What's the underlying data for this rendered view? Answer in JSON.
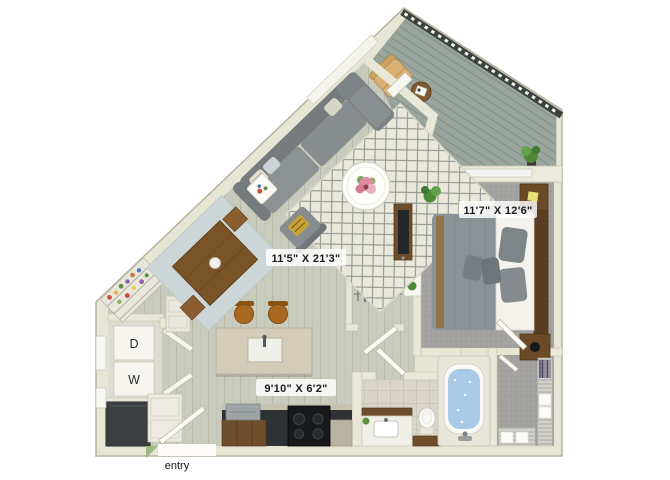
{
  "floorplan": {
    "type": "apartment-floor-plan-3d-top-view",
    "labels": {
      "living_dim": "11'5\" X 21'3\"",
      "bedroom_dim": "11'7\" X 12'6\"",
      "kitchen_dim": "9'10\" X 6'2\"",
      "entry": "entry",
      "dryer": "D",
      "washer": "W"
    },
    "rooms": [
      {
        "name": "living-dining",
        "dimensions": "11'5\" X 21'3\"",
        "floor": "light wood plank"
      },
      {
        "name": "bedroom",
        "dimensions": "11'7\" X 12'6\"",
        "floor": "gray carpet"
      },
      {
        "name": "kitchen",
        "dimensions": "9'10\" X 6'2\"",
        "floor": "light wood plank"
      },
      {
        "name": "bathroom",
        "floor": "beige tile"
      },
      {
        "name": "walk-in-closet",
        "floor": "gray carpet"
      },
      {
        "name": "balcony",
        "floor": "diagonal gray decking"
      },
      {
        "name": "laundry-closet",
        "appliances": [
          "D",
          "W"
        ]
      },
      {
        "name": "entry",
        "label": "entry"
      }
    ],
    "colors": {
      "background": "#ffffff",
      "wall": "#e7e5d4",
      "wall_edge": "#b5b3a0",
      "wood_floor": "#c9cbbc",
      "carpet": "#a3a2a0",
      "deck": "#9aa59d",
      "railing": "#3c433f",
      "rug": "#eae8db",
      "dining_rug": "#cdd6d7",
      "sofa_gray": "#868b8e",
      "furniture_wood": "#6e4d2a",
      "counter_dark": "#2f3234",
      "island_stone": "#d3ccb9",
      "tub_water": "#a9c9e6",
      "plant_green": "#5d9141",
      "accent_pillow": "#c9a23b"
    }
  }
}
